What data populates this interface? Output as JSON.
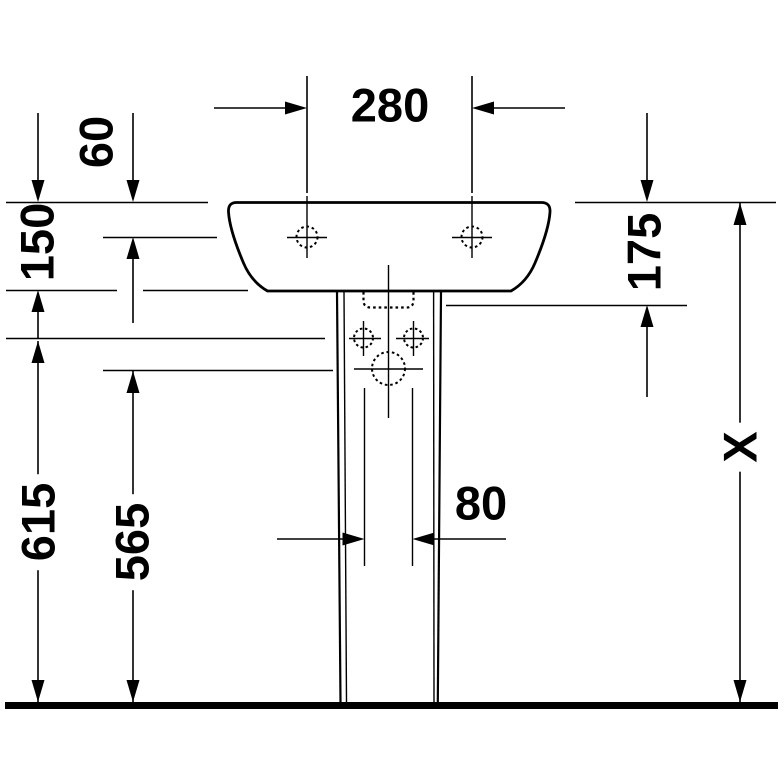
{
  "drawing": {
    "background_color": "#ffffff",
    "line_color": "#000000",
    "dimensions": [
      {
        "label": "280",
        "orientation": "horizontal"
      },
      {
        "label": "60",
        "orientation": "vertical"
      },
      {
        "label": "150",
        "orientation": "vertical"
      },
      {
        "label": "615",
        "orientation": "vertical"
      },
      {
        "label": "565",
        "orientation": "vertical"
      },
      {
        "label": "175",
        "orientation": "vertical"
      },
      {
        "label": "80",
        "orientation": "horizontal"
      },
      {
        "label": "X",
        "orientation": "vertical"
      }
    ]
  }
}
